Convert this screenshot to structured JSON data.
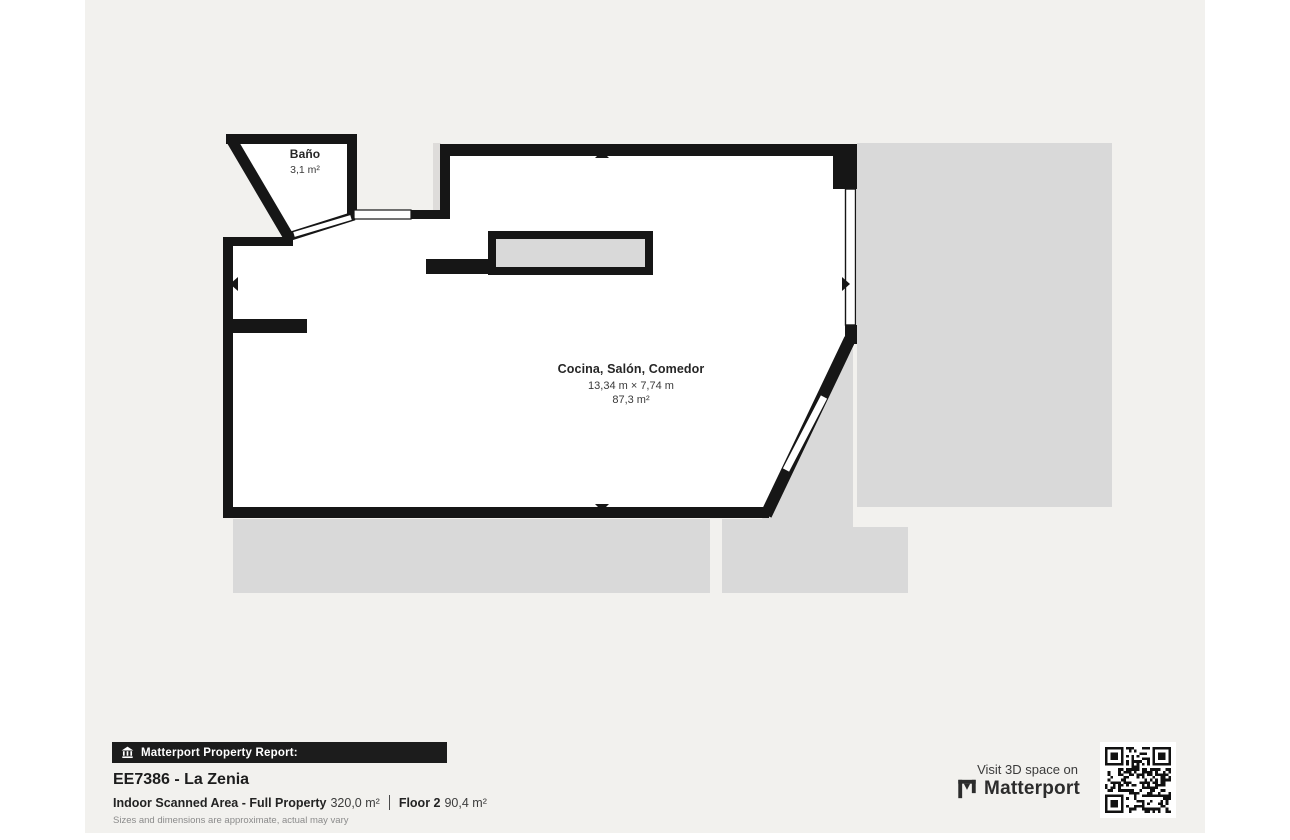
{
  "page": {
    "background_color": "#f2f1ee",
    "margin_color": "#ffffff"
  },
  "plan": {
    "wall_color": "#161616",
    "room_fill_color": "#ffffff",
    "adjacent_area_color": "#d9d9d9",
    "counter_fill_color": "#d9d9d9",
    "rooms": [
      {
        "name": "Baño",
        "area": "3,1 m²"
      },
      {
        "name": "Cocina, Salón, Comedor",
        "dimensions": "13,34 m × 7,74 m",
        "area": "87,3 m²"
      }
    ]
  },
  "footer": {
    "banner_label": "Matterport Property Report:",
    "property_title": "EE7386 - La Zenia",
    "scanned_area_label": "Indoor Scanned Area - Full Property",
    "scanned_area_value": "320,0 m²",
    "floor_label": "Floor 2",
    "floor_area_value": "90,4 m²",
    "disclaimer": "Sizes and dimensions are approximate, actual may vary"
  },
  "cta": {
    "visit_label": "Visit 3D space on",
    "brand": "Matterport"
  }
}
